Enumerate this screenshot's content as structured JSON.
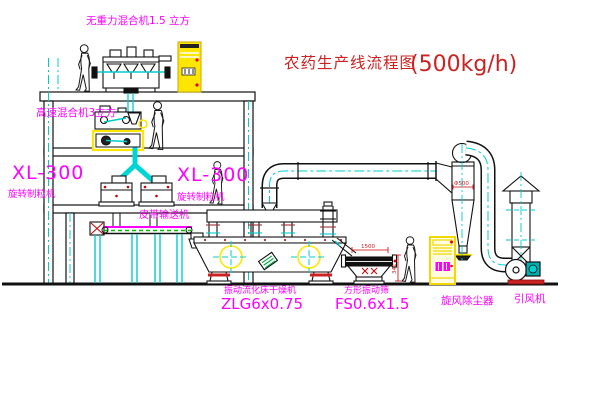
{
  "title": {
    "zh": "农药生产线流程图",
    "capacity": "(500kg/h)"
  },
  "labels": {
    "gravity_mixer": "无重力混合机1.5 立方",
    "high_speed_mixer": "高速混合机3立方",
    "granulator_left_model": "XL-300",
    "granulator_left_name": "旋转制粒机",
    "granulator_center_model": "XL-300",
    "granulator_center_name": "旋转制粒机",
    "belt_conveyor": "皮带输送机",
    "fluid_bed_dryer": "振动流化床干燥机",
    "fluid_bed_dryer_model": "ZLG6x0.75",
    "square_sieve": "方形振动筛",
    "square_sieve_model": "FS0.6x1.5",
    "cyclone": "旋风除尘器",
    "induced_fan": "引风机"
  },
  "dimensions": {
    "cyclone_dia": "Φ500",
    "sieve_length": "1500",
    "sieve_height": "341"
  },
  "colors": {
    "label_magenta": "#ff00ff",
    "title_red": "#cc2222",
    "centerline_cyan": "#00cccc",
    "equipment_yellow": "#ffe600",
    "accent_red": "#cc2222",
    "line_black": "#000000",
    "belt_green": "#00bb00"
  }
}
